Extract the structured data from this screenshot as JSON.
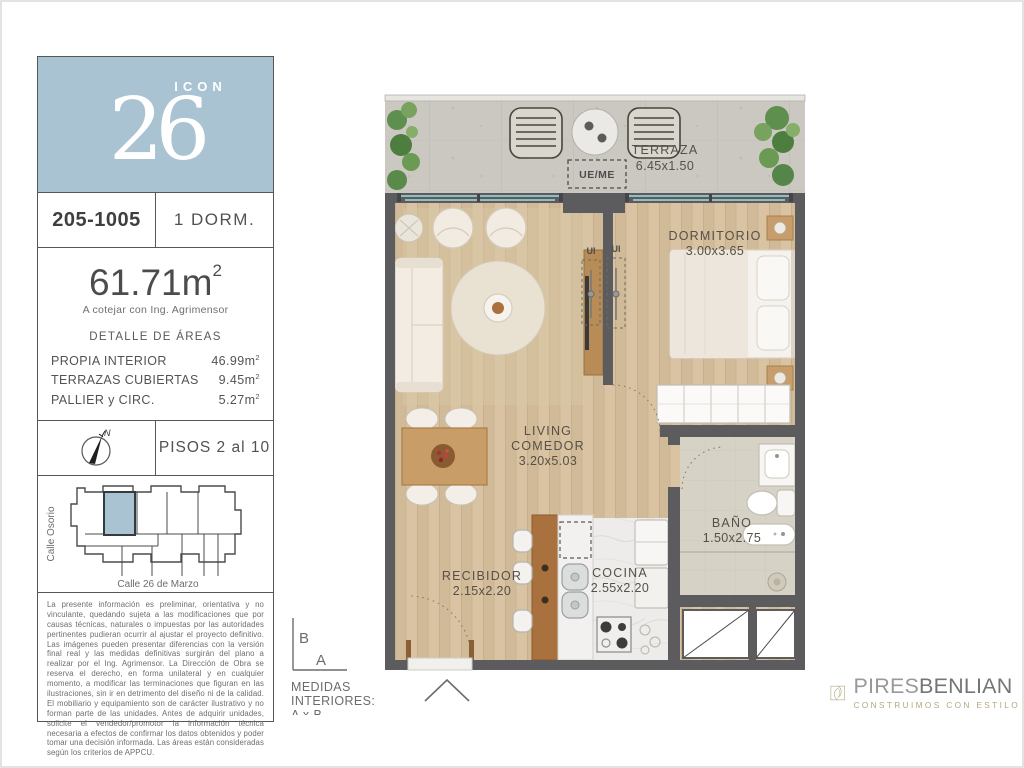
{
  "colors": {
    "accent_blue": "#a9c3d2",
    "brand_tan": "#ac9f72",
    "wall_gray": "#5c5c5e",
    "wood": "#d9c3a3"
  },
  "logo": {
    "number": "26",
    "word": "ICON"
  },
  "unit": {
    "code": "205-1005",
    "type": "1 DORM.",
    "total_area": "61.71",
    "unit_m": "m",
    "sup": "2",
    "area_note": "A cotejar con Ing. Agrimensor",
    "areas_title": "DETALLE DE ÁREAS",
    "areas": [
      {
        "label": "PROPIA INTERIOR",
        "value": "46.99"
      },
      {
        "label": "TERRAZAS CUBIERTAS",
        "value": "9.45"
      },
      {
        "label": "PALLIER y CIRC.",
        "value": "5.27"
      }
    ],
    "floors": "PISOS 2 al 10"
  },
  "compass": {
    "north": "N"
  },
  "keyplan": {
    "street_left": "Calle Osorio",
    "street_bottom": "Calle 26 de Marzo"
  },
  "legal": "La presente información es preliminar, orientativa y no vinculante, quedando sujeta a las modificaciones que por causas técnicas, naturales o impuestas por las autoridades pertinentes pudieran ocurrir al ajustar el proyecto definitivo. Las imágenes pueden presentar diferencias con la versión final real y las medidas definitivas surgirán del plano a realizar por el Ing. Agrimensor. La Dirección de Obra se reserva el derecho, en forma unilateral y en cualquier momento, a modificar las terminaciones que figuran en las ilustraciones, sin ir en detrimento del diseño ni de la calidad. El mobiliario y equipamiento son de carácter ilustrativo y no forman parte de las unidades. Antes de adquirir unidades, solicite el vendedor/promotor la información técnica necesaria a efectos de confirmar los datos obtenidos y poder tomar una decisión informada. Las áreas están consideradas según los criterios de APPCU.",
  "plan": {
    "terraza": {
      "name": "TERRAZA",
      "dims": "6.45x1.50"
    },
    "dormitorio": {
      "name": "DORMITORIO",
      "dims": "3.00x3.65"
    },
    "living": {
      "line1": "LIVING",
      "line2": "COMEDOR",
      "dims": "3.20x5.03"
    },
    "bano": {
      "name": "BAÑO",
      "dims": "1.50x2.75"
    },
    "cocina": {
      "name": "COCINA",
      "dims": "2.55x2.20"
    },
    "recibidor": {
      "name": "RECIBIDOR",
      "dims": "2.15x2.20"
    },
    "tags": {
      "ue_me": "UE/ME",
      "ui": "UI"
    },
    "medidas": {
      "b": "B",
      "a": "A",
      "line1": "MEDIDAS",
      "line2": "INTERIORES:",
      "line3": "A x B"
    }
  },
  "brand": {
    "name1": "PIRES",
    "name2": "BENLIAN",
    "tagline": "CONSTRUIMOS CON ESTILO"
  }
}
